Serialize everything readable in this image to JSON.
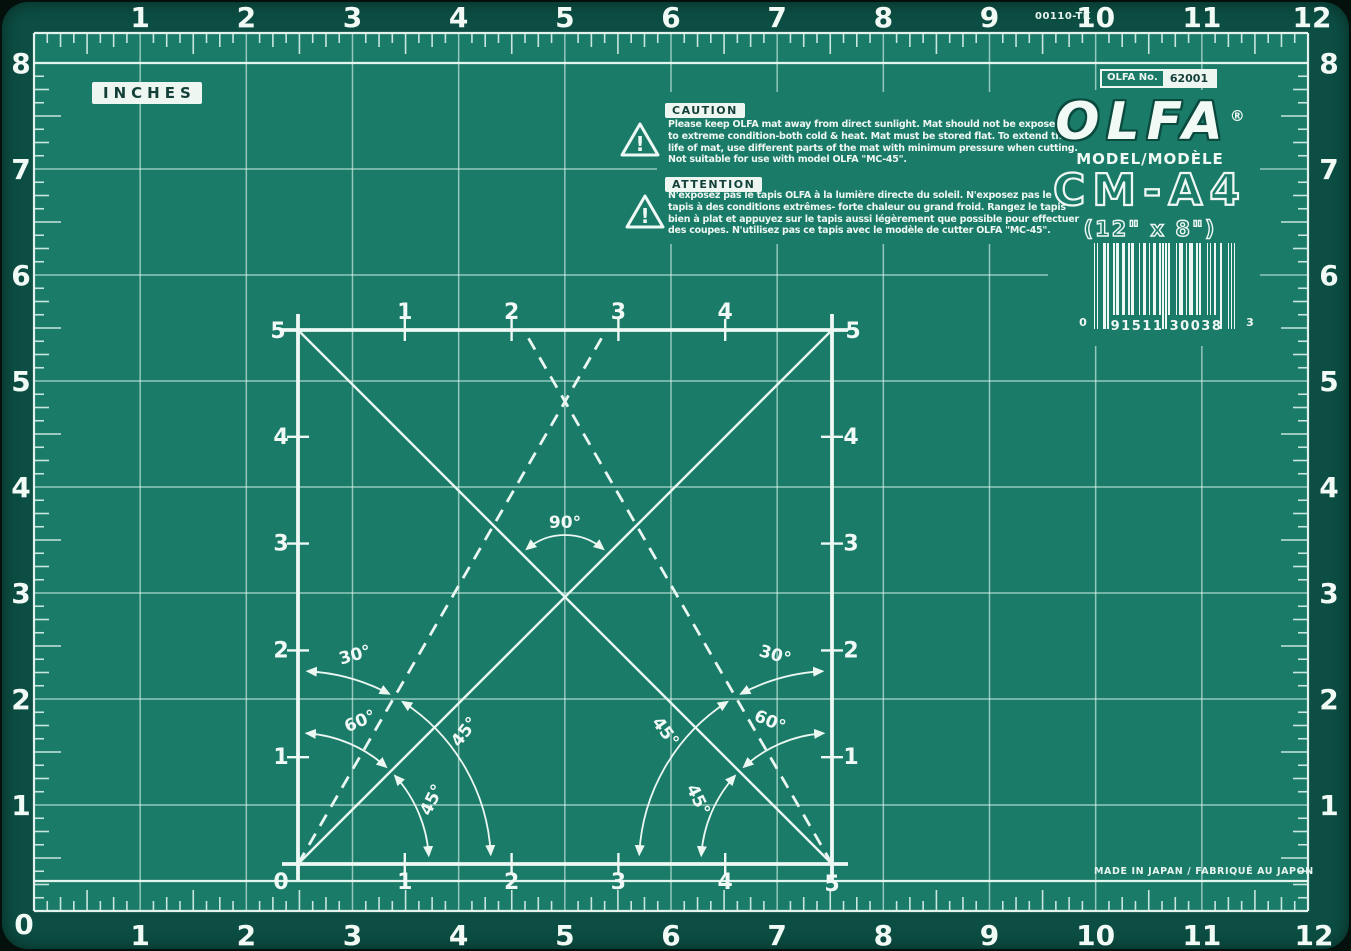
{
  "colors": {
    "surface": "#1a7b68",
    "border": "#0c4e43",
    "ink": "#eef8f4",
    "chip_text": "#123f37"
  },
  "ruler": {
    "inches_label": "INCHES",
    "part_number": "00110-TK",
    "top": [
      "1",
      "2",
      "3",
      "4",
      "5",
      "6",
      "7",
      "8",
      "9",
      "10",
      "11",
      "12"
    ],
    "bottom": [
      "1",
      "2",
      "3",
      "4",
      "5",
      "6",
      "7",
      "8",
      "9",
      "10",
      "11",
      "12"
    ],
    "left": [
      "8",
      "7",
      "6",
      "5",
      "4",
      "3",
      "2",
      "1",
      "0"
    ],
    "right": [
      "8",
      "7",
      "6",
      "5",
      "4",
      "3",
      "2",
      "1"
    ]
  },
  "warnings": {
    "mark": "!",
    "caution": {
      "title": "CAUTION",
      "lines": [
        "Please keep OLFA mat away from direct sunlight. Mat should not be exposed",
        "to extreme condition-both cold & heat. Mat must be stored flat. To extend the",
        "life of mat, use different parts of the mat with minimum pressure when cutting.",
        "Not suitable for use with model OLFA \"MC-45\"."
      ]
    },
    "attention": {
      "title": "ATTENTION",
      "lines": [
        "N'exposez pas le tapis OLFA à la lumière directe du soleil. N'exposez pas le",
        "tapis à des conditions extrêmes- forte chaleur ou grand froid. Rangez le tapis",
        "bien à plat et appuyez sur le tapis aussi légèrement que possible pour effectuer",
        "des coupes. N'utilisez pas ce tapis avec le modèle de cutter OLFA \"MC-45\"."
      ]
    }
  },
  "brand": {
    "no_label": "OLFA No.",
    "no_value": "62001",
    "logo": "OLFA",
    "registered": "®",
    "model_label": "MODEL/MODÈLE",
    "model_code": "CM-A4",
    "size": "(12\" x 8\")",
    "made_in": "MADE IN JAPAN / FABRIQUÉ AU JAPON"
  },
  "barcode": {
    "left_digit": "0",
    "group1": "91511",
    "group2": "30038",
    "check_digit": "3",
    "pattern": "10100011010001011001100101100010011001001100101010100001011100101110010100001010010001000010101"
  },
  "square": {
    "top_labels": [
      "1",
      "2",
      "3",
      "4"
    ],
    "bottom_labels": [
      "1",
      "2",
      "3",
      "4"
    ],
    "left_labels": [
      "4",
      "3",
      "2",
      "1"
    ],
    "right_labels": [
      "4",
      "3",
      "2",
      "1"
    ],
    "corner_top_left": "5",
    "corner_top_right": "5",
    "corner_bottom_left": "0",
    "corner_bottom_right": "5",
    "angles": {
      "ninety": "90°",
      "left": [
        "30°",
        "45°",
        "60°",
        "45°"
      ],
      "right": [
        "30°",
        "45°",
        "60°",
        "45°"
      ]
    }
  }
}
